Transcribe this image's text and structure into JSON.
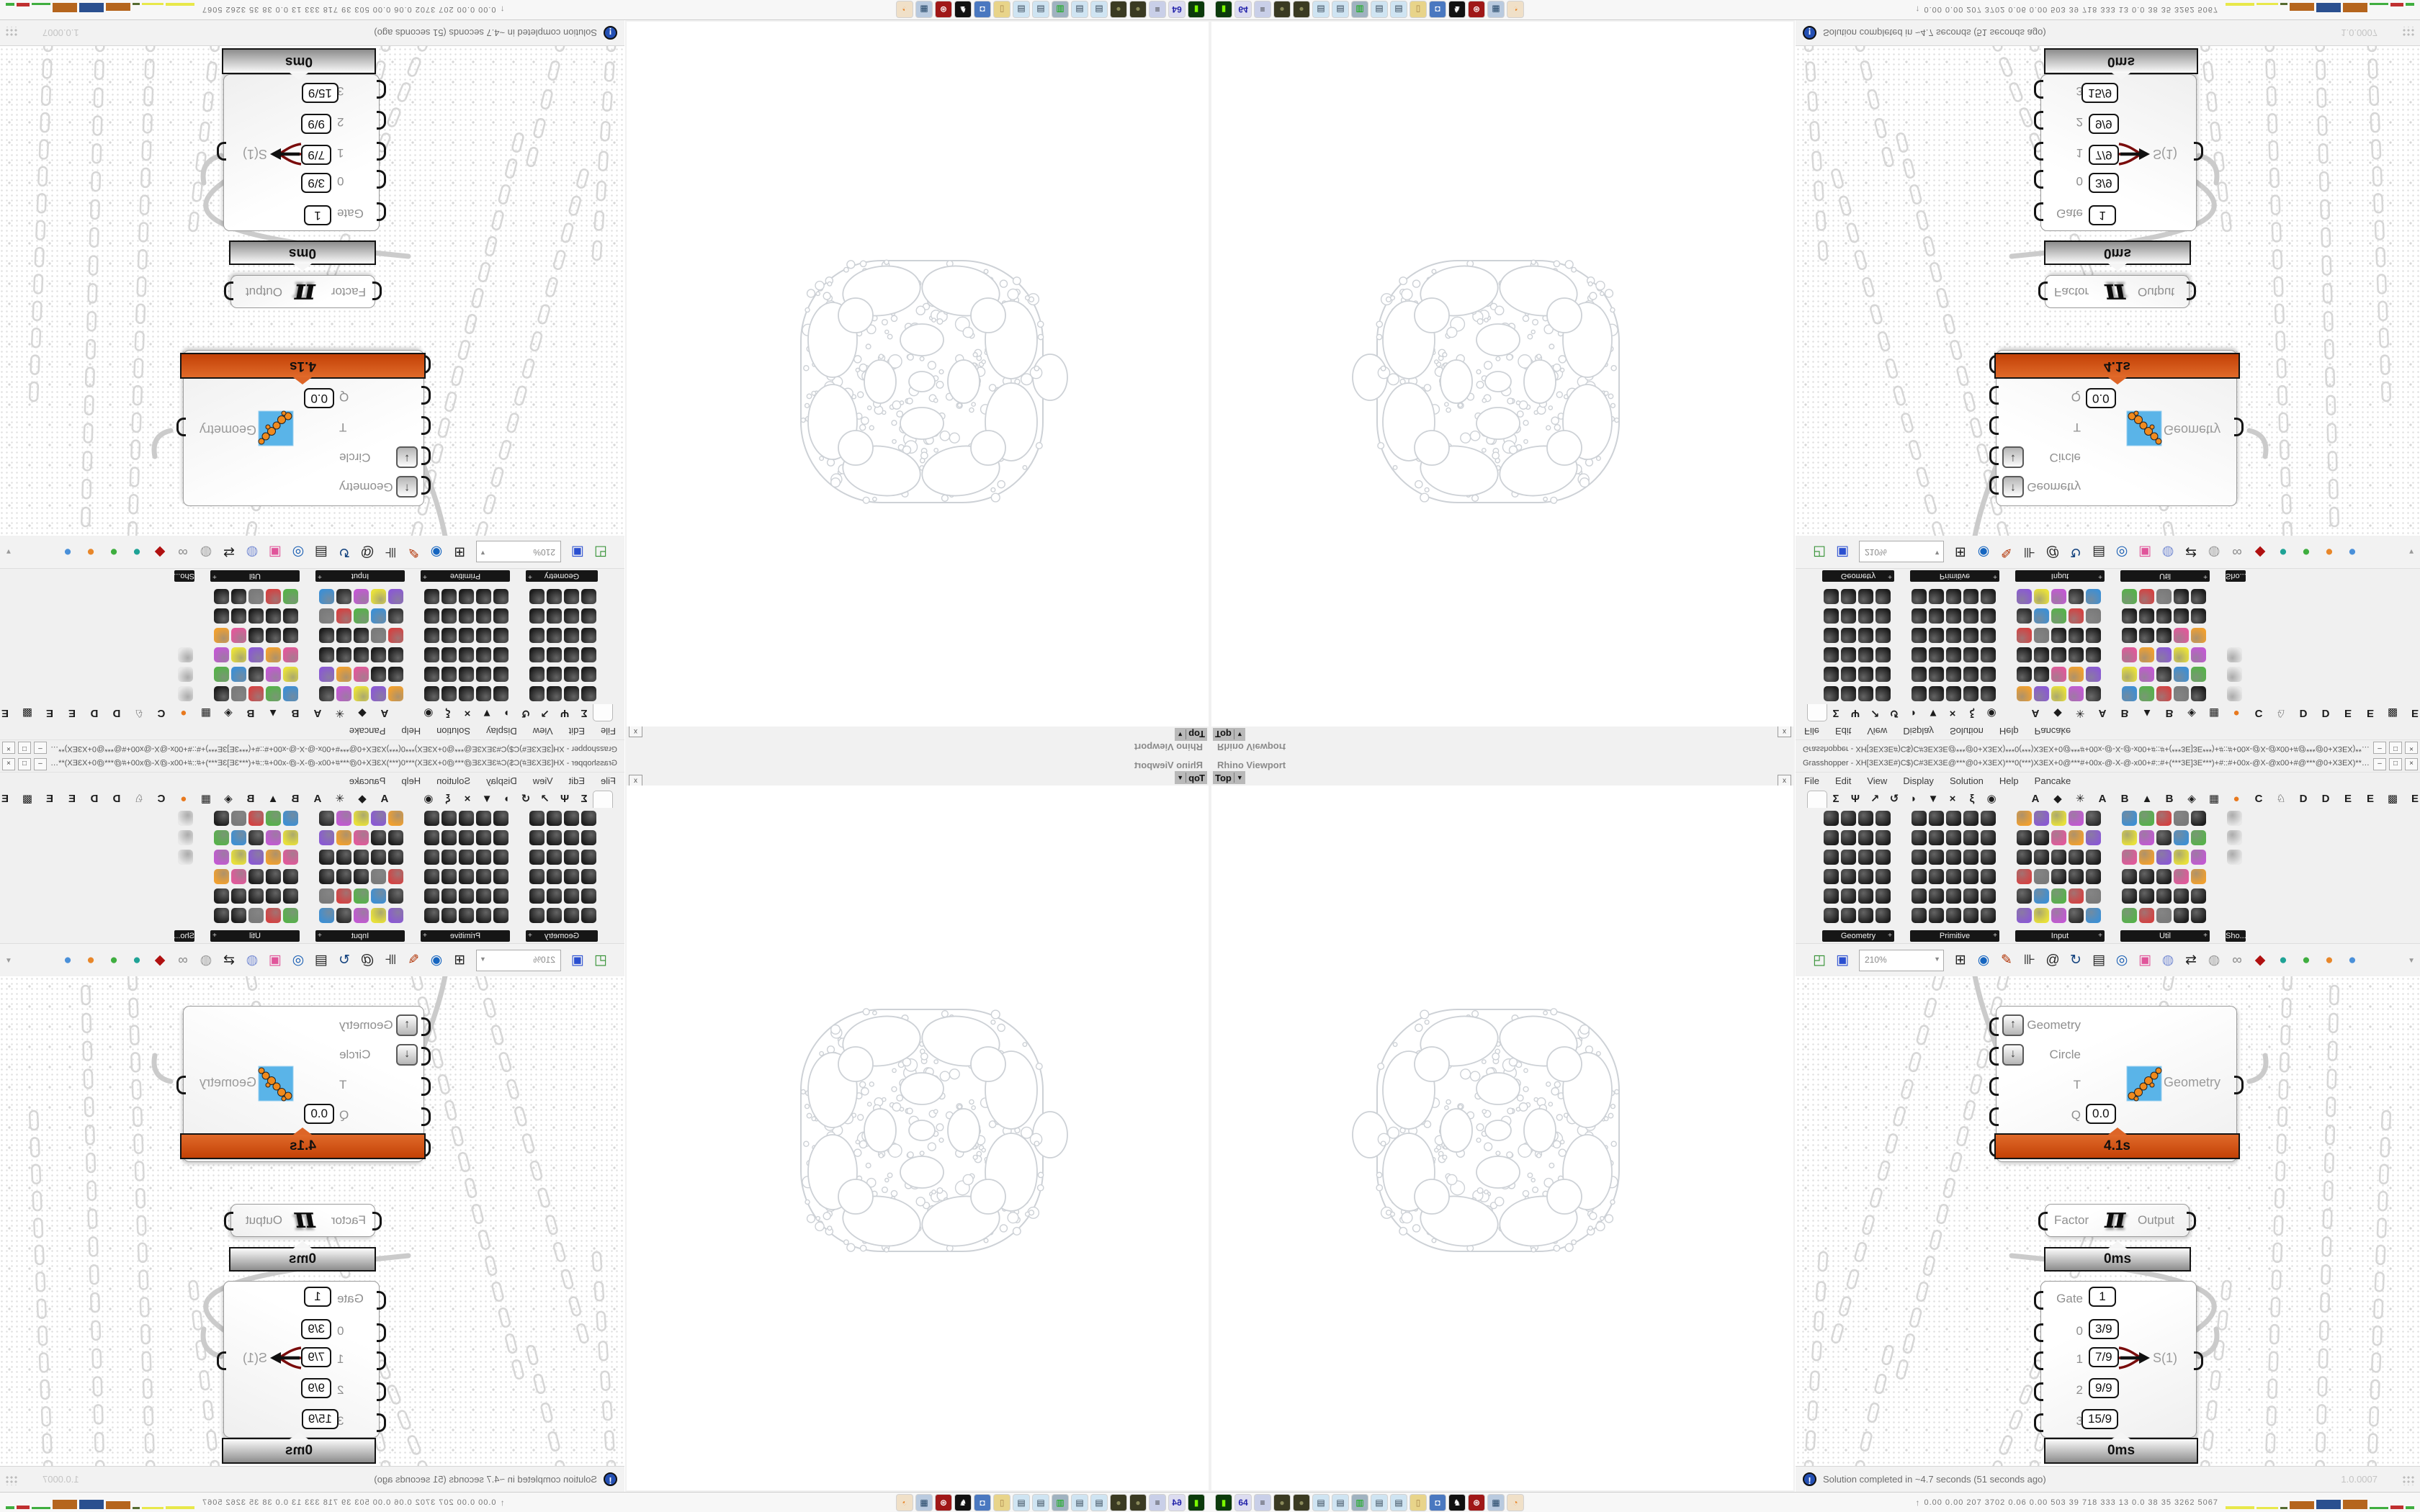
{
  "rhino": {
    "panel_title": "Rhino Viewport",
    "viewport_button": "Top",
    "viewport_caret": "▼",
    "close_button": "x"
  },
  "grasshopper": {
    "window_title": "Grasshopper - XH[3EX3E#)C$)C#3EX3E@***@0+X3EX)***0(***)X3EX+0@***#+00x-@-X-@-x00+#::#+(***3E]3E***)+#::#+00x-@X-@x00+#@***@0+X3EX)***0*** ...",
    "window_buttons": [
      "–",
      "□",
      "×"
    ],
    "menu": [
      "File",
      "Edit",
      "View",
      "Display",
      "Solution",
      "Help",
      "Pancake"
    ],
    "tabs": [
      {
        "glyph": "",
        "name": "params",
        "active": true,
        "hex": true
      },
      {
        "glyph": "Σ",
        "name": "maths"
      },
      {
        "glyph": "Ψ",
        "name": "sets"
      },
      {
        "glyph": "↗",
        "name": "vector"
      },
      {
        "glyph": "↺",
        "name": "curve"
      },
      {
        "glyph": "◗",
        "name": "surface"
      },
      {
        "glyph": "▼",
        "name": "mesh"
      },
      {
        "glyph": "×",
        "name": "intersect"
      },
      {
        "glyph": "ξ",
        "name": "transform"
      },
      {
        "glyph": "◉",
        "name": "display"
      },
      {
        "glyph": "A",
        "name": "plugin-a1"
      },
      {
        "glyph": "◆",
        "name": "plugin-gem"
      },
      {
        "glyph": "✳",
        "name": "plugin-gear"
      },
      {
        "glyph": "A",
        "name": "plugin-a2"
      },
      {
        "glyph": "B",
        "name": "plugin-b1"
      },
      {
        "glyph": "▲",
        "name": "plugin-mountain"
      },
      {
        "glyph": "B",
        "name": "plugin-b2"
      },
      {
        "glyph": "◈",
        "name": "plugin-shield"
      },
      {
        "glyph": "▦",
        "name": "plugin-grid"
      },
      {
        "glyph": "●",
        "name": "plugin-orange-dot",
        "color": "#e8791e"
      },
      {
        "glyph": "C",
        "name": "plugin-c"
      },
      {
        "glyph": "♘",
        "name": "plugin-bird"
      },
      {
        "glyph": "D",
        "name": "plugin-d1"
      },
      {
        "glyph": "D",
        "name": "plugin-d2"
      },
      {
        "glyph": "E",
        "name": "plugin-e1"
      },
      {
        "glyph": "E",
        "name": "plugin-e2"
      },
      {
        "glyph": "▩",
        "name": "plugin-dashed"
      },
      {
        "glyph": "E",
        "name": "plugin-e3"
      }
    ],
    "palettes": [
      {
        "label": "Geometry",
        "cols": 4,
        "rows": 6,
        "style": "dark"
      },
      {
        "label": "Primitive",
        "cols": 5,
        "rows": 6,
        "style": "dark"
      },
      {
        "label": "Input",
        "cols": 5,
        "rows": 6,
        "style": "mixed"
      },
      {
        "label": "Util",
        "cols": 5,
        "rows": 6,
        "style": "mixed"
      },
      {
        "label": "Sho...",
        "cols": 1,
        "rows": 3,
        "style": "light"
      }
    ],
    "palette_colors": [
      "#1d1d1d",
      "#2e2e2e",
      "#e05a9a",
      "#1d1d1d",
      "#3f8fd2",
      "#f0a030",
      "#1d1d1d",
      "#57b14b",
      "#8a5ad2",
      "#1d1d1d",
      "#d24343",
      "#e8e03a",
      "#1d1d1d",
      "#7a7a7a",
      "#c25ad2",
      "#1d1d1d"
    ],
    "toolbar": {
      "zoom_level": "210%",
      "zoom_caret": "▼",
      "overflow_caret": "▼",
      "icons": [
        {
          "name": "open-file",
          "glyph": "◰",
          "color": "#2f8f2f"
        },
        {
          "name": "save-file",
          "glyph": "▣",
          "color": "#2a4fd0"
        },
        {
          "name": "zoom-extents",
          "glyph": "⊞",
          "color": "#222222"
        },
        {
          "name": "preview-eye",
          "glyph": "◉",
          "color": "#1565c0"
        },
        {
          "name": "sketch-pen",
          "glyph": "✎",
          "color": "#b03000"
        },
        {
          "name": "gate",
          "glyph": "⊪",
          "color": "#222222"
        },
        {
          "name": "author-at",
          "glyph": "@",
          "color": "#222222"
        },
        {
          "name": "gha-loader",
          "glyph": "↻",
          "color": "#13427e"
        },
        {
          "name": "image-capture",
          "glyph": "▤",
          "color": "#222222"
        },
        {
          "name": "find-magnifier",
          "glyph": "◎",
          "color": "#1a5fb4"
        },
        {
          "name": "help-box",
          "glyph": "▣",
          "color": "#e0559a"
        },
        {
          "name": "balloon",
          "glyph": "◍",
          "color": "#7a8fd4"
        },
        {
          "name": "jumble",
          "glyph": "⇄",
          "color": "#222222"
        },
        {
          "name": "balloon-gray",
          "glyph": "◍",
          "color": "#9a9a9a"
        },
        {
          "name": "spheres-gray",
          "glyph": "∞",
          "color": "#8a8a8a"
        },
        {
          "name": "gem-red",
          "glyph": "◆",
          "color": "#b01010"
        },
        {
          "name": "quality-teal",
          "glyph": "●",
          "color": "#1fa396"
        },
        {
          "name": "quality-green",
          "glyph": "●",
          "color": "#3fae3f"
        },
        {
          "name": "quality-orange",
          "glyph": "●",
          "color": "#e8872a"
        },
        {
          "name": "quality-blue",
          "glyph": "●",
          "color": "#4a90d9"
        }
      ]
    },
    "components": {
      "fixsphere": {
        "rows": [
          {
            "label": "Geometry",
            "widget": "up"
          },
          {
            "label": "Circle",
            "widget": "down"
          },
          {
            "label": "T",
            "widget": "none"
          },
          {
            "label": "Q",
            "widget": "box",
            "value": "0.0"
          },
          {
            "label": "FixSphere",
            "widget": "toggle"
          }
        ],
        "output_label": "Geometry",
        "profiler": "4.1s"
      },
      "factor": {
        "input_label": "Factor",
        "symbol": "π",
        "output_label": "Output",
        "profiler": "0ms"
      },
      "stream_filter": {
        "rows": [
          {
            "label": "Gate",
            "value": "1"
          },
          {
            "label": "0",
            "value": "3/9"
          },
          {
            "label": "1",
            "value": "7/9"
          },
          {
            "label": "2",
            "value": "9/9"
          },
          {
            "label": "3",
            "value": "15/9"
          }
        ],
        "output_label": "S(1)",
        "active_row": 2,
        "profiler": "0ms"
      }
    },
    "statusbar": {
      "icon": "!",
      "message": "Solution completed in ~4.7 seconds (51 seconds ago)",
      "version": "1.0.0007"
    }
  },
  "taskbar": {
    "launchers": [
      {
        "name": "terminal",
        "glyph": "▮",
        "bg": "#0b3a0b",
        "fg": "#7cfc00"
      },
      {
        "name": "floppy-64",
        "glyph": "64",
        "bg": "#dcdcf0",
        "fg": "#2222aa"
      },
      {
        "name": "script",
        "glyph": "≡",
        "bg": "#c9cfe8",
        "fg": "#333333"
      },
      {
        "name": "grenade-1",
        "glyph": "●",
        "bg": "#3a3a22",
        "fg": "#8a8a5a"
      },
      {
        "name": "grenade-2",
        "glyph": "●",
        "bg": "#3a3a22",
        "fg": "#8a8a5a"
      },
      {
        "name": "notepad-1",
        "glyph": "▤",
        "bg": "#cfe4f2",
        "fg": "#334455"
      },
      {
        "name": "notepad-2",
        "glyph": "▤",
        "bg": "#cfe4f2",
        "fg": "#334455"
      },
      {
        "name": "monitor-green",
        "glyph": "▥",
        "bg": "#9fb2c0",
        "fg": "#00aa00"
      },
      {
        "name": "notepad-3",
        "glyph": "▤",
        "bg": "#cfe4f2",
        "fg": "#334455"
      },
      {
        "name": "notepad-4",
        "glyph": "▤",
        "bg": "#cfe4f2",
        "fg": "#334455"
      },
      {
        "name": "folder",
        "glyph": "▯",
        "bg": "#e8d48a",
        "fg": "#a8864a"
      },
      {
        "name": "computer-blue",
        "glyph": "◘",
        "bg": "#4a78c0",
        "fg": "#ffffff"
      },
      {
        "name": "black-white-app",
        "glyph": "♞",
        "bg": "#111111",
        "fg": "#ffffff"
      },
      {
        "name": "red-gear-app",
        "glyph": "⊛",
        "bg": "#a01818",
        "fg": "#ffffff"
      },
      {
        "name": "calculator",
        "glyph": "▦",
        "bg": "#b9cadf",
        "fg": "#224466"
      },
      {
        "name": "firefox",
        "glyph": "◔",
        "bg": "#f0e0c8",
        "fg": "#e8872a"
      }
    ],
    "monitor": {
      "prefix": "↑",
      "values": "0.00 0.00 207 3702 0.06 0.00 503 39 718 333 13 0.0 38 35 3262 5067",
      "bars": [
        {
          "w": 40,
          "h": 4,
          "color": "#e8e84a"
        },
        {
          "w": 30,
          "h": 3,
          "color": "#e8e84a"
        },
        {
          "w": 10,
          "h": 3,
          "color": "#556b2f"
        },
        {
          "w": 34,
          "h": 11,
          "color": "#b5651d"
        },
        {
          "w": 34,
          "h": 13,
          "color": "#2a4f8f"
        },
        {
          "w": 34,
          "h": 13,
          "color": "#b5651d"
        },
        {
          "w": 26,
          "h": 3,
          "color": "#3fae3f"
        },
        {
          "w": 18,
          "h": 5,
          "color": "#c03030"
        },
        {
          "w": 12,
          "h": 4,
          "color": "#3fae3f"
        }
      ]
    }
  }
}
